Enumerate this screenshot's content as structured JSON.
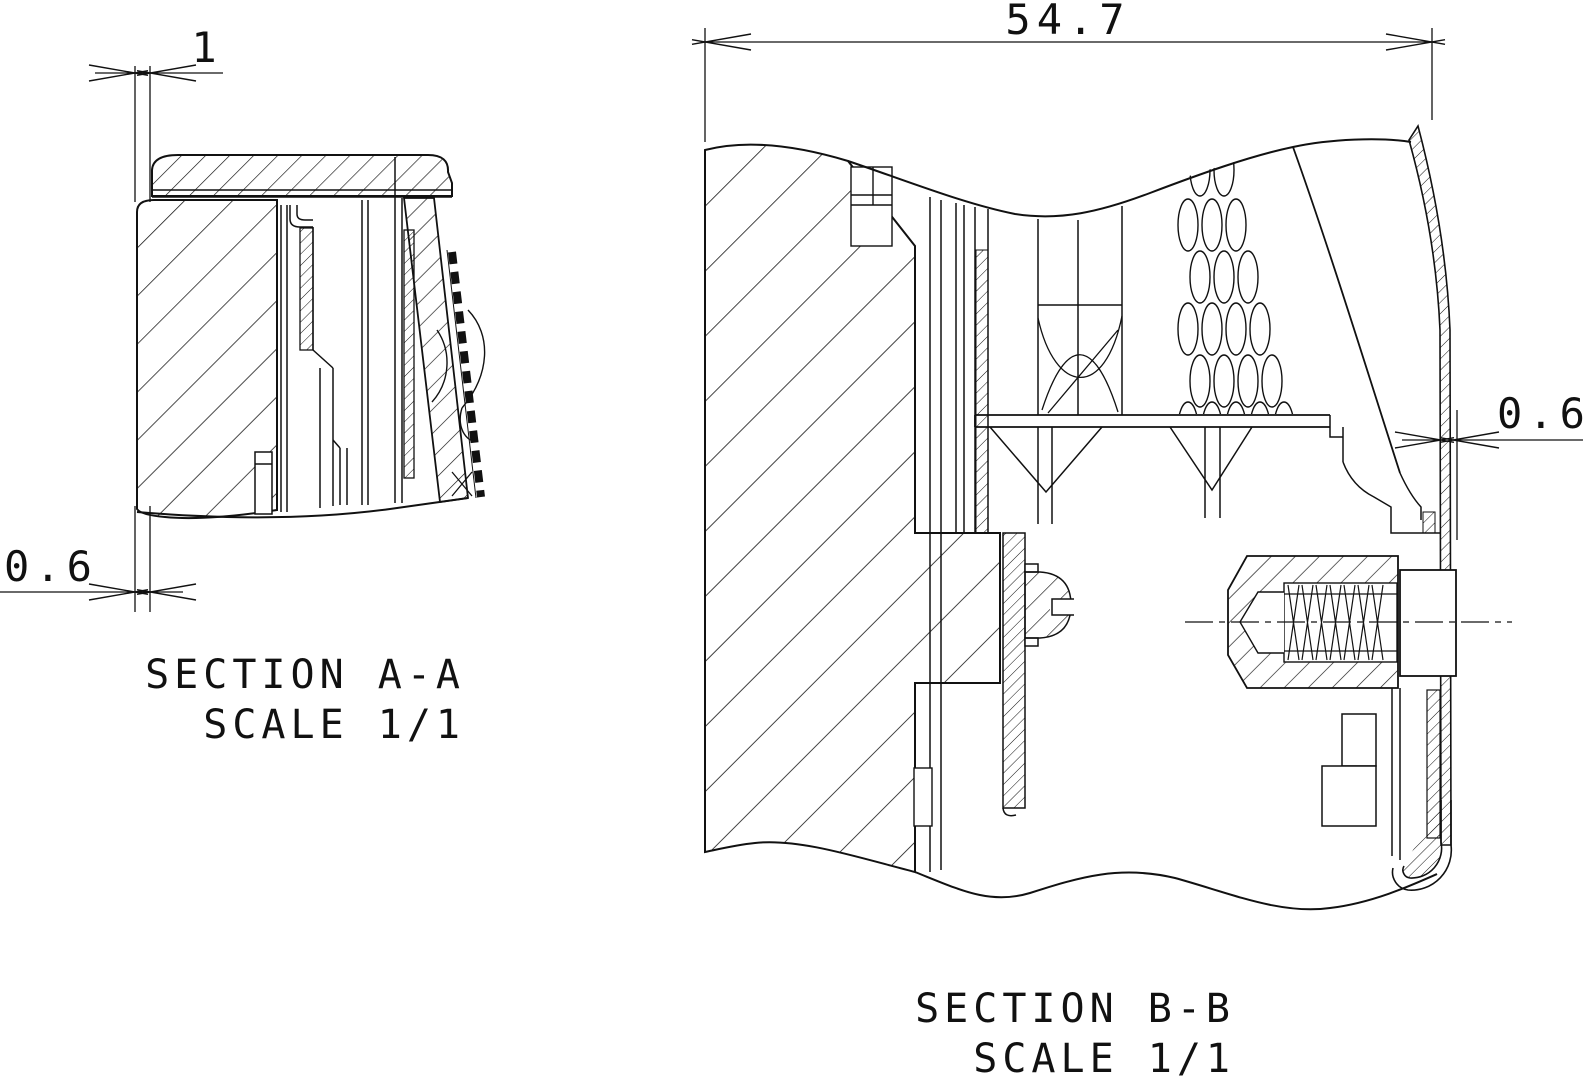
{
  "page": {
    "background": "#ffffff",
    "line_color": "#111111",
    "type_note": "engineering section drawing"
  },
  "views": {
    "section_a": {
      "title": "SECTION A-A",
      "scale": "SCALE 1/1",
      "dimensions": {
        "cap_wall_thickness_top": "1",
        "cap_wall_thickness_bottom": "0.6"
      }
    },
    "section_b": {
      "title": "SECTION B-B",
      "scale": "SCALE 1/1",
      "dimensions": {
        "overall_width": "54.7",
        "shell_wall_thickness": "0.6"
      }
    }
  }
}
